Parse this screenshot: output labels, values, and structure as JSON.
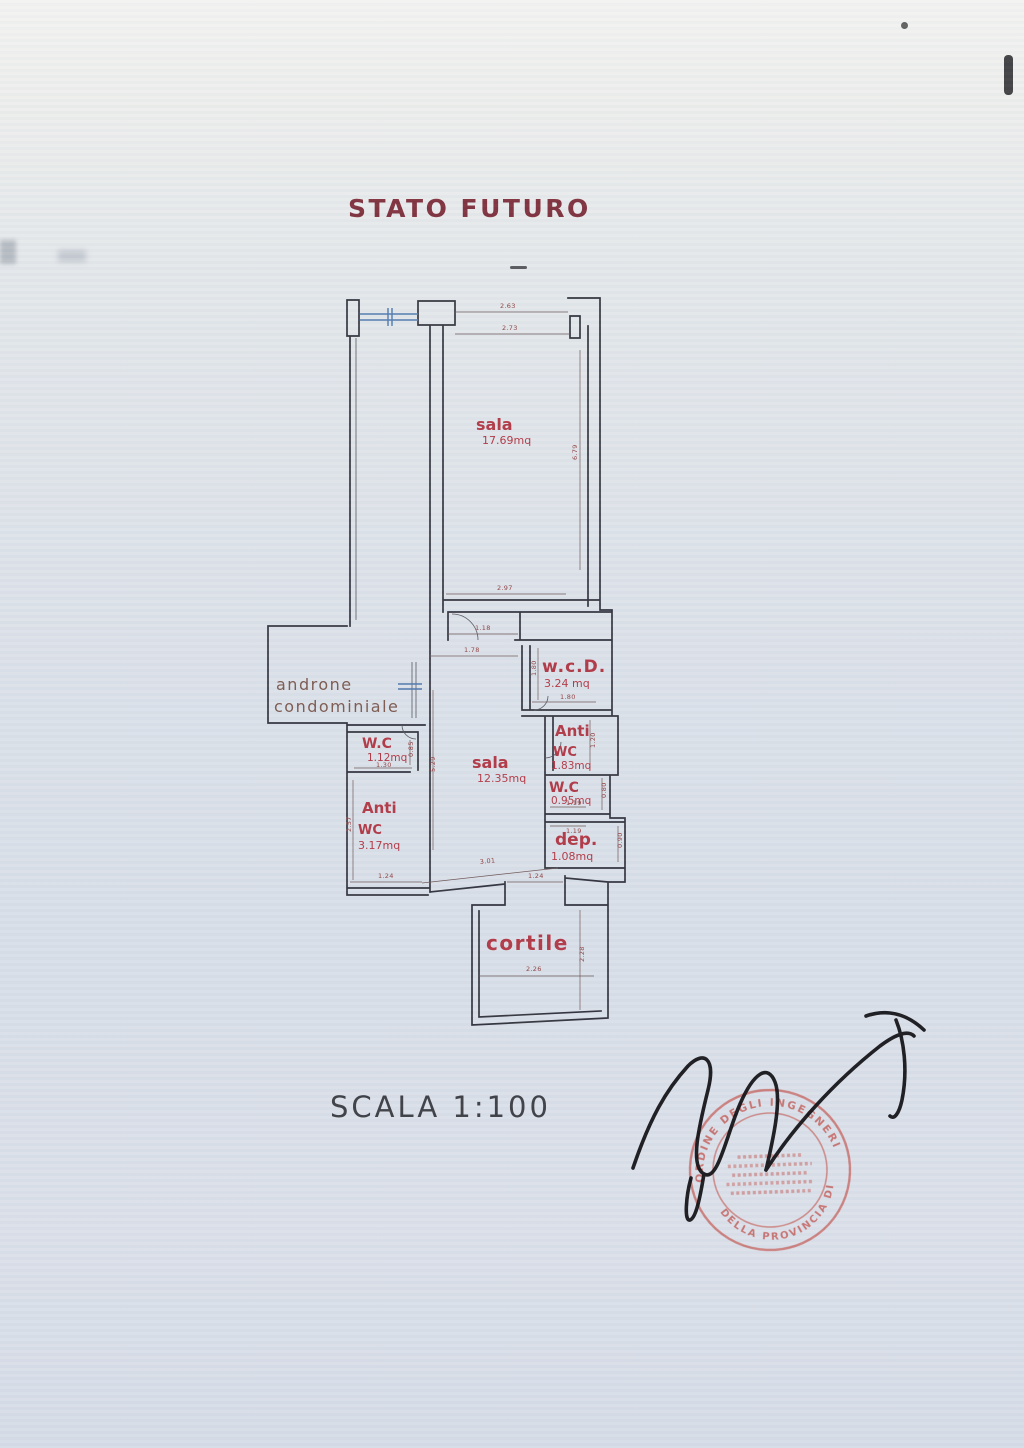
{
  "document": {
    "title": "STATO FUTURO",
    "scale_label": "SCALA 1:100"
  },
  "plan": {
    "rooms": {
      "sala_grande": {
        "name": "sala",
        "area": "17.69mq"
      },
      "wcd": {
        "name": "w.c.D.",
        "area": "3.24 mq"
      },
      "anti_wc_dx": {
        "line1": "Anti",
        "line2": "WC",
        "area": "1.83mq"
      },
      "wc_dx": {
        "name": "W.C",
        "area": "0.95mq"
      },
      "dep": {
        "name": "dep.",
        "area": "1.08mq"
      },
      "wc_sx": {
        "name": "W.C",
        "area": "1.12mq"
      },
      "anti_wc_sx": {
        "line1": "Anti",
        "line2": "WC",
        "area": "3.17mq"
      },
      "sala_piccola": {
        "name": "sala",
        "area": "12.35mq"
      },
      "cortile": {
        "name": "cortile"
      },
      "androne": {
        "line1": "androne",
        "line2": "condominiale"
      }
    },
    "dims": {
      "top1": "2.63",
      "top2": "2.73",
      "sala_height": "6.79",
      "sala_width": "2.97",
      "pass_a": "1.18",
      "pass_b": "1.78",
      "wcd_height": "1.80",
      "wcd_width": "1.80",
      "anti_dx_height": "1.20",
      "wc_dx_width": "1.19",
      "wc_dx_height": "0.80",
      "dep_width": "1.19",
      "dep_height": "0.90",
      "wc_sx_width": "1.30",
      "wc_sx_height": "0.85",
      "anti_sx_height": "2.57",
      "anti_sx_width": "1.24",
      "hall_height": "5.29",
      "diag": "3.01",
      "cortile_top": "1.24",
      "cortile_height": "2.28",
      "cortile_width": "2.26"
    }
  },
  "stamp": {
    "ring_top": "ORDINE DEGLI INGEGNERI",
    "ring_bottom": "DELLA PROVINCIA DI"
  },
  "colors": {
    "label_red": "#b23946",
    "wall": "#33343e",
    "window_blue": "#4f79ae",
    "stamp_red": "#c4544c",
    "title_red": "#80333f",
    "scale_gray": "#3e4046"
  }
}
